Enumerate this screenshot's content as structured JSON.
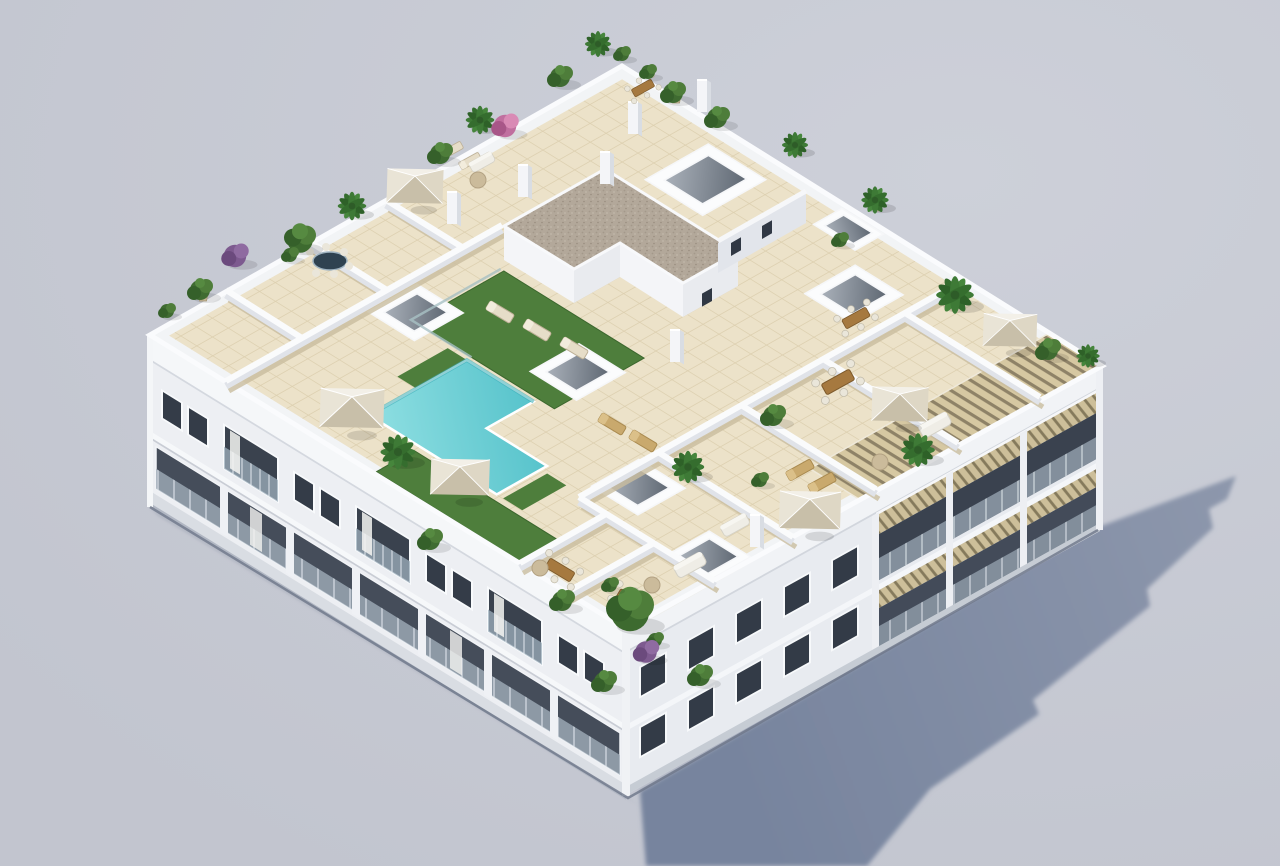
{
  "scene": {
    "title": "Aerial isometric 3D architectural rendering of a white apartment building with rooftop terrace, L-shaped pool, private terraces, parasols and plants",
    "render_style": "photorealistic exterior visualization, no text or UI elements",
    "background": {
      "color": "#c7cad3"
    },
    "ground_shadow": {
      "direction": "lower-right",
      "color_near": "#77849e",
      "color_far": "#8d97ac"
    },
    "building": {
      "facade_color": "#edeff3",
      "facade_shaded_color": "#e8ebf0",
      "parapet_color": "#f5f7f9",
      "window_glass_color": "#3a424e",
      "railing_glass_color": "#9fb0bd",
      "floors_visible": 3
    },
    "rooftop": {
      "tile_color": "#ece2c9",
      "tile_grout_color": "#dccfaf",
      "lawn_color": "#4e7e3c",
      "stair_core_roof_color": "#b3a89a",
      "pergola_slat_color": "#d6c8a2",
      "parasol_color": "#efebe0",
      "pool": {
        "shape": "L-shaped",
        "water_color_light": "#8fdfe2",
        "water_color_deep": "#45bac4",
        "coping_color": "#ffffff"
      },
      "parasol_count": 6,
      "skylight_count": 7,
      "chimney_count": 7,
      "sun_lounger_count": 9,
      "dining_set_count": 6,
      "private_terrace_count": 10
    },
    "vegetation": {
      "shrub_color": "#3f6b31",
      "palm_color": "#3e7a36",
      "purple_shrub_color": "#7d5a8f",
      "pink_shrub_color": "#c06f9f",
      "palm_count": 10,
      "shrub_count": 20
    }
  }
}
